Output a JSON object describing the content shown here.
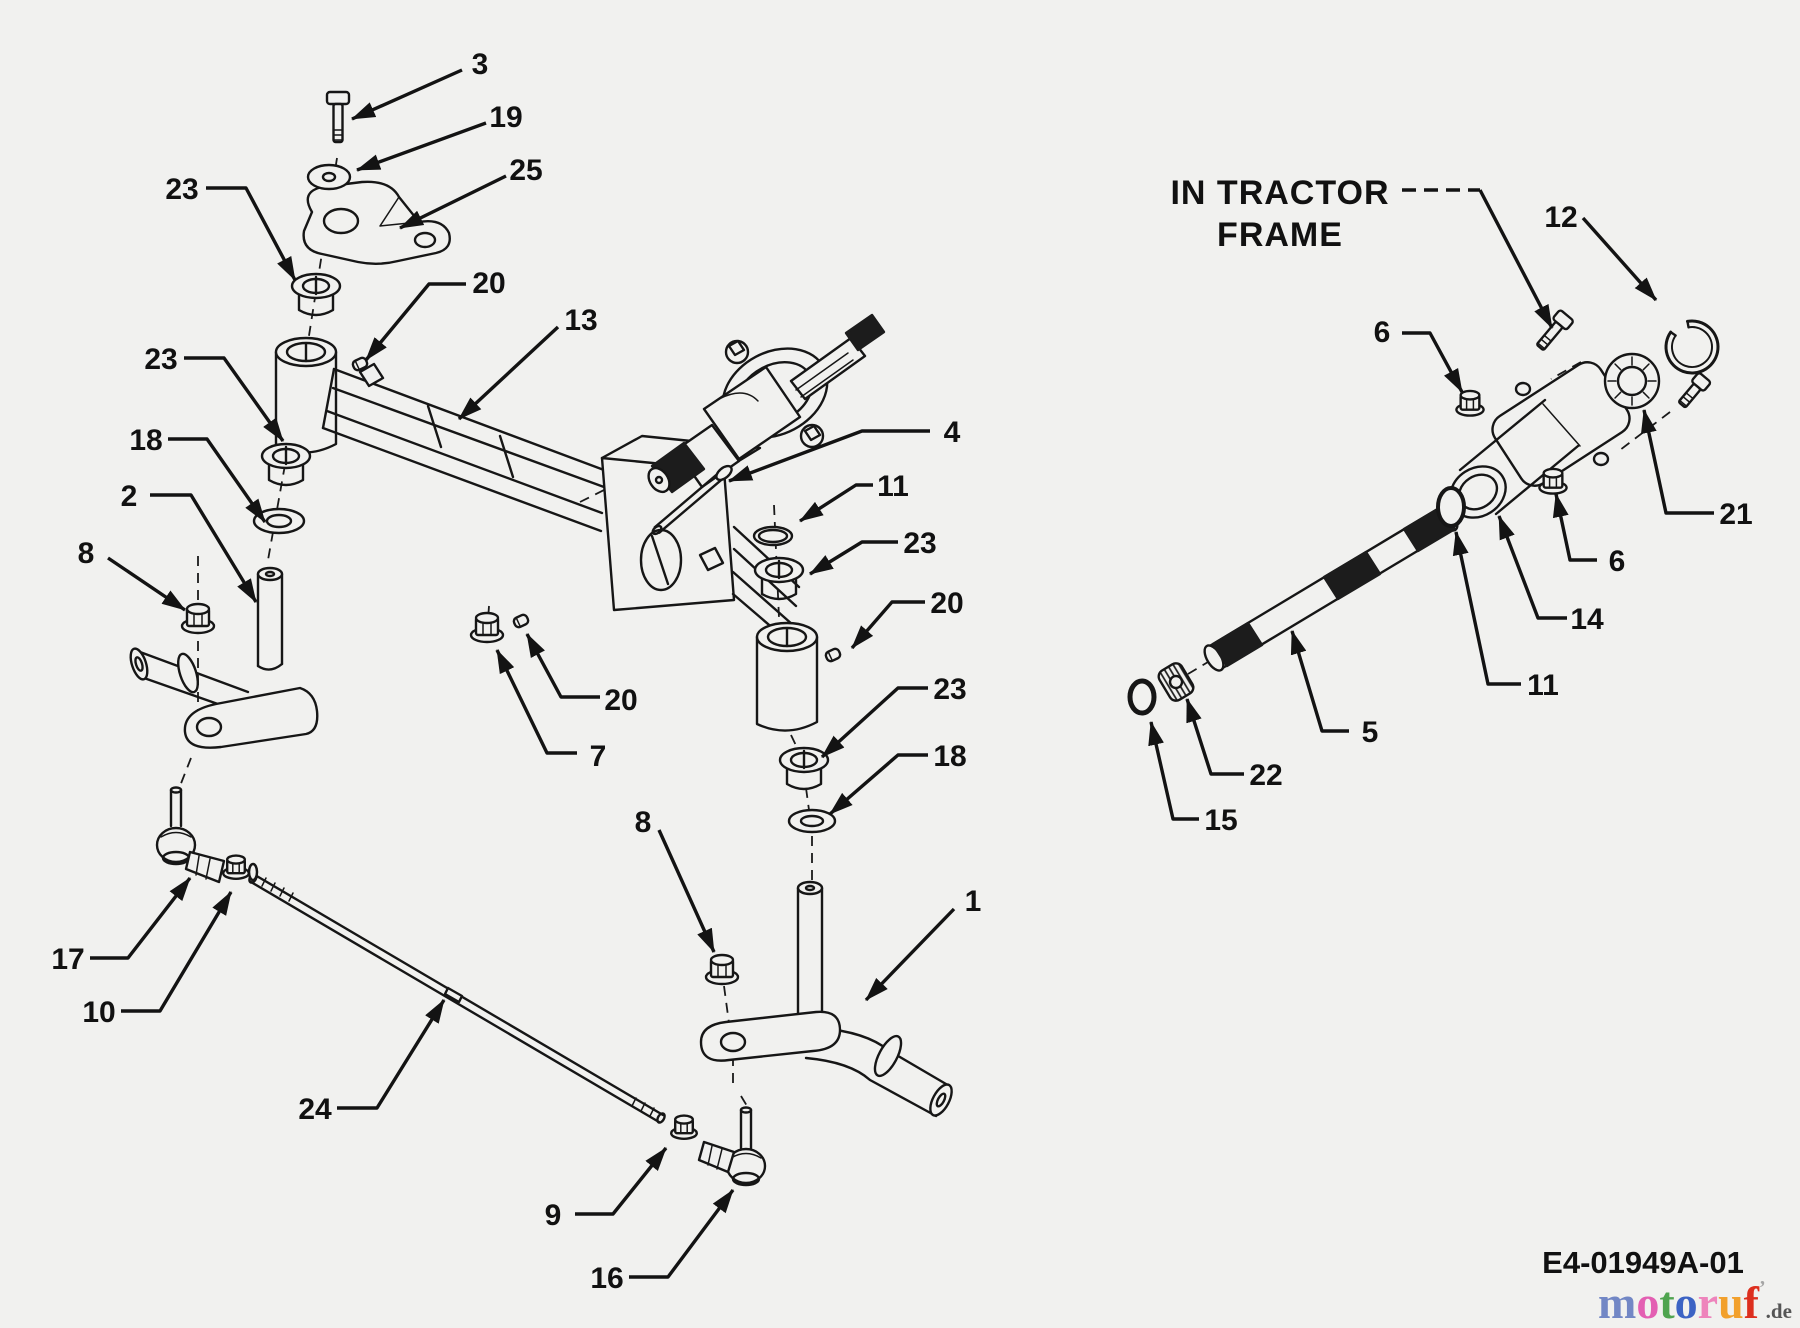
{
  "figure": {
    "bg": "#f1f1ef",
    "ink": "#161616",
    "note": {
      "lines": [
        "IN TRACTOR",
        "FRAME"
      ],
      "x": 1280,
      "y1": 192,
      "y2": 234,
      "leader_dash": [
        1402,
        190,
        1480,
        190
      ],
      "leader": [
        [
          1480,
          190
        ],
        [
          1552,
          328
        ]
      ]
    },
    "doc_code": {
      "text": "E4-01949A-01",
      "x": 1643,
      "y": 1273
    },
    "logo": {
      "letters": [
        {
          "ch": "m",
          "color": "#7287c5"
        },
        {
          "ch": "o",
          "color": "#e35fb2"
        },
        {
          "ch": "t",
          "color": "#4fa44f"
        },
        {
          "ch": "o",
          "color": "#3c63c4"
        },
        {
          "ch": "r",
          "color": "#ee84bc"
        },
        {
          "ch": "u",
          "color": "#f2a02c"
        },
        {
          "ch": "f",
          "color": "#dd2f1e"
        }
      ],
      "tick": {
        "ch": "’",
        "color": "#a5a5a5"
      },
      "suffix": {
        "ch": ".de",
        "color": "#555555"
      },
      "x": 1598,
      "y": 1318
    },
    "callouts": [
      {
        "n": "3",
        "lx": 480,
        "ly": 63,
        "pts": [
          [
            462,
            70
          ],
          [
            352,
            119
          ]
        ]
      },
      {
        "n": "19",
        "lx": 506,
        "ly": 116,
        "pts": [
          [
            486,
            123
          ],
          [
            357,
            170
          ]
        ]
      },
      {
        "n": "25",
        "lx": 526,
        "ly": 169,
        "pts": [
          [
            506,
            176
          ],
          [
            400,
            228
          ]
        ]
      },
      {
        "n": "23",
        "lx": 182,
        "ly": 188,
        "pts": [
          [
            206,
            188
          ],
          [
            246,
            188
          ],
          [
            295,
            280
          ]
        ]
      },
      {
        "n": "20",
        "lx": 489,
        "ly": 282,
        "pts": [
          [
            466,
            284
          ],
          [
            429,
            284
          ],
          [
            366,
            360
          ]
        ]
      },
      {
        "n": "13",
        "lx": 581,
        "ly": 319,
        "pts": [
          [
            558,
            327
          ],
          [
            459,
            419
          ]
        ]
      },
      {
        "n": "23",
        "lx": 161,
        "ly": 358,
        "pts": [
          [
            184,
            358
          ],
          [
            224,
            358
          ],
          [
            283,
            441
          ]
        ]
      },
      {
        "n": "18",
        "lx": 146,
        "ly": 439,
        "pts": [
          [
            168,
            439
          ],
          [
            207,
            439
          ],
          [
            265,
            522
          ]
        ]
      },
      {
        "n": "2",
        "lx": 129,
        "ly": 495,
        "pts": [
          [
            150,
            495
          ],
          [
            191,
            495
          ],
          [
            256,
            602
          ]
        ]
      },
      {
        "n": "8",
        "lx": 86,
        "ly": 552,
        "pts": [
          [
            108,
            558
          ],
          [
            185,
            610
          ]
        ]
      },
      {
        "n": "4",
        "lx": 952,
        "ly": 431,
        "pts": [
          [
            930,
            431
          ],
          [
            862,
            431
          ],
          [
            729,
            481
          ]
        ]
      },
      {
        "n": "11",
        "lx": 893,
        "ly": 485,
        "pts": [
          [
            873,
            485
          ],
          [
            856,
            485
          ],
          [
            800,
            521
          ]
        ]
      },
      {
        "n": "23",
        "lx": 920,
        "ly": 542,
        "pts": [
          [
            898,
            542
          ],
          [
            862,
            542
          ],
          [
            810,
            574
          ]
        ]
      },
      {
        "n": "20",
        "lx": 947,
        "ly": 602,
        "pts": [
          [
            925,
            602
          ],
          [
            892,
            602
          ],
          [
            852,
            648
          ]
        ]
      },
      {
        "n": "23",
        "lx": 950,
        "ly": 688,
        "pts": [
          [
            928,
            688
          ],
          [
            898,
            688
          ],
          [
            822,
            757
          ]
        ]
      },
      {
        "n": "18",
        "lx": 950,
        "ly": 755,
        "pts": [
          [
            928,
            755
          ],
          [
            898,
            755
          ],
          [
            830,
            814
          ]
        ]
      },
      {
        "n": "8",
        "lx": 643,
        "ly": 821,
        "pts": [
          [
            659,
            830
          ],
          [
            714,
            952
          ]
        ]
      },
      {
        "n": "7",
        "lx": 598,
        "ly": 755,
        "pts": [
          [
            577,
            753
          ],
          [
            547,
            753
          ],
          [
            497,
            650
          ]
        ]
      },
      {
        "n": "20",
        "lx": 621,
        "ly": 699,
        "pts": [
          [
            600,
            697
          ],
          [
            561,
            697
          ],
          [
            527,
            634
          ]
        ]
      },
      {
        "n": "17",
        "lx": 68,
        "ly": 958,
        "pts": [
          [
            90,
            958
          ],
          [
            128,
            958
          ],
          [
            190,
            878
          ]
        ]
      },
      {
        "n": "10",
        "lx": 99,
        "ly": 1011,
        "pts": [
          [
            121,
            1011
          ],
          [
            160,
            1011
          ],
          [
            231,
            892
          ]
        ]
      },
      {
        "n": "24",
        "lx": 315,
        "ly": 1108,
        "pts": [
          [
            337,
            1108
          ],
          [
            377,
            1108
          ],
          [
            444,
            1000
          ]
        ]
      },
      {
        "n": "9",
        "lx": 553,
        "ly": 1214,
        "pts": [
          [
            575,
            1214
          ],
          [
            613,
            1214
          ],
          [
            666,
            1148
          ]
        ]
      },
      {
        "n": "16",
        "lx": 607,
        "ly": 1277,
        "pts": [
          [
            629,
            1277
          ],
          [
            668,
            1277
          ],
          [
            733,
            1190
          ]
        ]
      },
      {
        "n": "1",
        "lx": 973,
        "ly": 900,
        "pts": [
          [
            954,
            909
          ],
          [
            866,
            1000
          ]
        ]
      },
      {
        "n": "12",
        "lx": 1561,
        "ly": 216,
        "pts": [
          [
            1583,
            218
          ],
          [
            1656,
            300
          ]
        ]
      },
      {
        "n": "6",
        "lx": 1382,
        "ly": 331,
        "pts": [
          [
            1402,
            333
          ],
          [
            1430,
            333
          ],
          [
            1462,
            392
          ]
        ]
      },
      {
        "n": "21",
        "lx": 1736,
        "ly": 513,
        "pts": [
          [
            1714,
            513
          ],
          [
            1666,
            513
          ],
          [
            1644,
            410
          ]
        ]
      },
      {
        "n": "6",
        "lx": 1617,
        "ly": 560,
        "pts": [
          [
            1597,
            560
          ],
          [
            1570,
            560
          ],
          [
            1556,
            494
          ]
        ]
      },
      {
        "n": "14",
        "lx": 1587,
        "ly": 618,
        "pts": [
          [
            1567,
            618
          ],
          [
            1538,
            618
          ],
          [
            1499,
            516
          ]
        ]
      },
      {
        "n": "11",
        "lx": 1543,
        "ly": 684,
        "pts": [
          [
            1521,
            684
          ],
          [
            1488,
            684
          ],
          [
            1456,
            532
          ]
        ]
      },
      {
        "n": "5",
        "lx": 1370,
        "ly": 731,
        "pts": [
          [
            1349,
            731
          ],
          [
            1322,
            731
          ],
          [
            1292,
            631
          ]
        ]
      },
      {
        "n": "22",
        "lx": 1266,
        "ly": 774,
        "pts": [
          [
            1244,
            774
          ],
          [
            1211,
            774
          ],
          [
            1187,
            699
          ]
        ]
      },
      {
        "n": "15",
        "lx": 1221,
        "ly": 819,
        "pts": [
          [
            1199,
            819
          ],
          [
            1173,
            819
          ],
          [
            1151,
            722
          ]
        ]
      }
    ],
    "parts": [
      {
        "type": "bolt",
        "name": "hex-bolt-3",
        "x": 338,
        "y": 106,
        "rot": 0,
        "len": 38,
        "hw": 11
      },
      {
        "type": "washer",
        "name": "washer-19",
        "x": 329,
        "y": 177,
        "rx": 21,
        "ry": 12,
        "irx": 6,
        "iry": 4
      },
      {
        "type": "bushing",
        "name": "flange-bushing-23",
        "x": 316,
        "y": 286
      },
      {
        "type": "setscrew",
        "name": "set-screw-20",
        "x": 360,
        "y": 364,
        "rot": -25
      },
      {
        "type": "bushing",
        "name": "flange-bushing-23",
        "x": 286,
        "y": 456
      },
      {
        "type": "washer",
        "name": "flat-washer-18",
        "x": 279,
        "y": 521,
        "rx": 25,
        "ry": 12,
        "irx": 12,
        "iry": 6
      },
      {
        "type": "nut",
        "name": "flange-nut-8",
        "x": 198,
        "y": 617,
        "s": 1
      },
      {
        "type": "washer",
        "name": "o-ring-11",
        "x": 773,
        "y": 536,
        "rx": 19,
        "ry": 9,
        "irx": 14,
        "iry": 6
      },
      {
        "type": "bushing",
        "name": "flange-bushing-23",
        "x": 779,
        "y": 570
      },
      {
        "type": "setscrew",
        "name": "set-screw-20",
        "x": 833,
        "y": 655,
        "rot": -25
      },
      {
        "type": "bushing",
        "name": "flange-bushing-23",
        "x": 804,
        "y": 760
      },
      {
        "type": "washer",
        "name": "flat-washer-18",
        "x": 812,
        "y": 821,
        "rx": 23,
        "ry": 11,
        "irx": 11,
        "iry": 5
      },
      {
        "type": "nut",
        "name": "flange-nut-8",
        "x": 722,
        "y": 968,
        "s": 1
      },
      {
        "type": "nut",
        "name": "flange-nut-7",
        "x": 487,
        "y": 626,
        "s": 1
      },
      {
        "type": "setscrew",
        "name": "set-screw-20",
        "x": 521,
        "y": 621,
        "rot": -25
      },
      {
        "type": "nut",
        "name": "jam-nut-10",
        "x": 236,
        "y": 866,
        "s": 0.8
      },
      {
        "type": "oring",
        "name": "lock-washer-10",
        "x": 253,
        "y": 872,
        "rx": 4,
        "ry": 8,
        "w": 2.5
      },
      {
        "type": "nut",
        "name": "jam-nut-9",
        "x": 684,
        "y": 1126,
        "s": 0.8
      },
      {
        "type": "pin",
        "name": "clevis-pin-4",
        "x1": 657,
        "y1": 530,
        "x2": 724,
        "y2": 473
      },
      {
        "type": "bolt",
        "name": "hex-bolt-12",
        "x": 1558,
        "y": 326,
        "rot": 40,
        "len": 30,
        "hw": 9
      },
      {
        "type": "snapring",
        "name": "snap-ring-12",
        "x": 1692,
        "y": 347,
        "r": 26
      },
      {
        "type": "bearing",
        "name": "ball-bearing-21",
        "x": 1632,
        "y": 381,
        "r1": 27,
        "r2": 14
      },
      {
        "type": "bolt",
        "name": "hex-bolt-right",
        "x": 1696,
        "y": 388,
        "rot": 40,
        "len": 24,
        "hw": 8
      },
      {
        "type": "nut",
        "name": "hex-nut-6",
        "x": 1470,
        "y": 402,
        "s": 0.85
      },
      {
        "type": "nut",
        "name": "hex-nut-6",
        "x": 1553,
        "y": 480,
        "s": 0.85
      },
      {
        "type": "oring",
        "name": "o-ring-11",
        "x": 1451,
        "y": 507,
        "rx": 13,
        "ry": 19,
        "w": 4
      },
      {
        "type": "nbearing",
        "name": "needle-bearing-22",
        "x": 1176,
        "y": 682
      },
      {
        "type": "oring",
        "name": "snap-ring-15",
        "x": 1142,
        "y": 697,
        "rx": 12,
        "ry": 16,
        "w": 5
      }
    ],
    "dashes": [
      [
        337,
        158,
        308,
        342
      ],
      [
        288,
        448,
        268,
        560
      ],
      [
        198,
        556,
        198,
        744
      ],
      [
        191,
        758,
        180,
        786
      ],
      [
        774,
        505,
        779,
        618
      ],
      [
        791,
        735,
        800,
        754
      ],
      [
        806,
        788,
        809,
        810
      ],
      [
        812,
        836,
        812,
        882
      ],
      [
        724,
        986,
        731,
        1038
      ],
      [
        733,
        1056,
        733,
        1090
      ],
      [
        741,
        1096,
        747,
        1106
      ],
      [
        580,
        502,
        648,
        468
      ],
      [
        1188,
        674,
        1208,
        662
      ],
      [
        1454,
        510,
        1476,
        497
      ],
      [
        1539,
        450,
        1560,
        434
      ],
      [
        1581,
        362,
        1551,
        379
      ],
      [
        1670,
        412,
        1620,
        450
      ],
      [
        1652,
        380,
        1640,
        390
      ],
      [
        489,
        606,
        488,
        620
      ]
    ]
  }
}
